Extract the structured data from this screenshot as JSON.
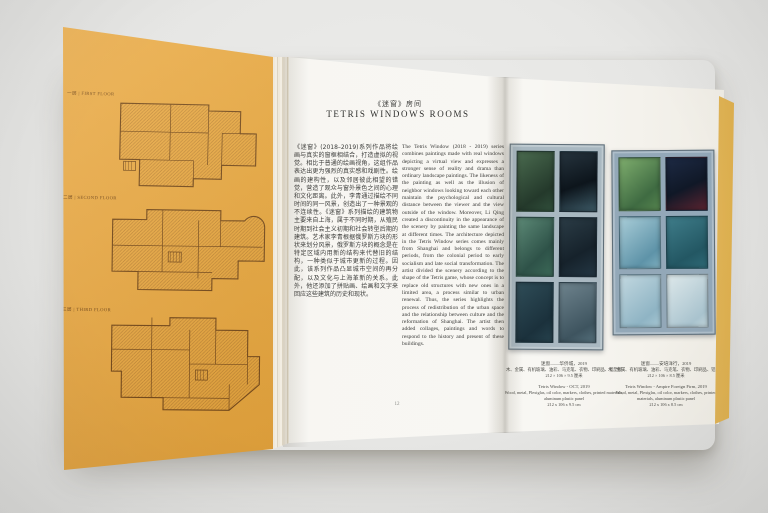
{
  "left_page": {
    "plans": [
      {
        "label": "一层 | FIRST FLOOR"
      },
      {
        "label": "二层 | SECOND FLOOR"
      },
      {
        "label": "三层 | THIRD FLOOR"
      }
    ]
  },
  "center_page": {
    "title_zh": "《迷窗》房间",
    "title_en": "TETRIS WINDOWS ROOMS",
    "body_zh": "《迷窗》(2018–2019)系列作品将绘画与真实的窗框相结合，打造虚拟的视觉。相比于普通的绘画视角，这组作品表达出更为强烈的真实感和戏剧性。绘画的建构性，以及邻居彼此相望的错觉，营造了观众与窗外景色之间的心理和文化距离。此外，李青通过描绘不同时间的同一风景，创造出了一种景观的不连续性。《迷窗》系列描绘的建筑物主要来自上海，属于不同时期，从殖民时期到社会主义初期和社会转型后期的建筑。艺术家李青根据俄罗斯方块的形状来划分风景，俄罗斯方块的概念是在特定区域内用新的结构来代替旧的结构，一种类似于城市更新的过程。因此，该系列作品凸显城市空间的再分配，以及文化与上海革新的关系。此外，他还添加了拼贴画、绘画和文字来回应这些建筑的历史和现状。",
    "body_en": "The Tetris Window (2018 - 2019) series combines paintings made with real windows depicting a virtual view and expresses a stronger sense of reality and drama than ordinary landscape paintings. The likeness of the painting as well as the illusion of neighbor windows looking toward each other maintain the psychological and cultural distance between the viewer and the view outside of the window. Moreover, Li Qing created a discontinuity in the appearance of the scenery by painting the same landscape at different times. The architecture depicted in the Tetris Window series comes mainly from Shanghai and belongs to different periods, from the colonial period to early socialism and late social transformation. The artist divided the scenery according to the shape of the Tetris game, whose concept is to replace old structures with new ones in a limited area, a process similar to urban renewal. Thus, the series highlights the process of redistribution of the urban space and the relationship between culture and the reformation of Shanghai. The artist then added collages, paintings and words to respond to the history and present of these buildings.",
    "page_number": "12"
  },
  "right_page": {
    "artworks": [
      {
        "caption_zh_title": "迷窗——华侨城，2019",
        "caption_zh_materials": "木、金属、有机玻璃、油彩、马克笔、衣物、印刷品、铝塑板",
        "caption_zh_dims": "212 × 106 × 9.5 厘米",
        "caption_en_title": "Tetris Window - OCT, 2019",
        "caption_en_materials": "Wood, metal, Plexiglas, oil color, markers, clothes, printed materials, aluminum plastic panel",
        "caption_en_dims": "212 x 106 x 9.5 cm",
        "frame_color": "#a9b8c1",
        "panes": [
          "linear-gradient(145deg,#4a6b4f,#24392b 70%,#31503c)",
          "linear-gradient(160deg,#26343e,#0d151c 55%,#3d5a66)",
          "linear-gradient(135deg,#5d8a77,#2e5248 65%,#3c6a58)",
          "linear-gradient(150deg,#2b3c46,#16222b 60%,#243744)",
          "linear-gradient(140deg,#2f4d58,#1b313c 70%,#27434e)",
          "linear-gradient(150deg,#6e838d,#3e545f 75%,#55707c)"
        ]
      },
      {
        "caption_zh_title": "迷窗——安培洋行，2019",
        "caption_zh_materials": "木、金属、有机玻璃、油彩、马克笔、衣物、印刷品、铝塑板",
        "caption_zh_dims": "212 × 106 × 8.5 厘米",
        "caption_en_title": "Tetris Window - Ampire Foreign Firm, 2019",
        "caption_en_materials": "Wood, metal, Plexiglas, oil color, markers, clothes, printed materials, aluminum plastic panel",
        "caption_en_dims": "212 x 106 x 8.5 cm",
        "frame_color": "#93a8b8",
        "panes": [
          "linear-gradient(140deg,#7fae6e,#3f6b42 70%,#56854f)",
          "linear-gradient(155deg,#1d2a44,#101827 55%,#5a2430)",
          "linear-gradient(140deg,#a9cdd8,#5e93a8 75%,#7fb0c0)",
          "linear-gradient(150deg,#3f7d8a,#235763 70%,#2f6a77)",
          "linear-gradient(140deg,#c2d8e0,#8fb4c4 75%,#a8c8d4)",
          "linear-gradient(140deg,#dde8ea,#aac4cf 80%,#c4d8de)"
        ]
      }
    ]
  },
  "colors": {
    "cover_orange": "#e2a138",
    "plan_line": "#6e4418",
    "page_white": "#f6f5f1",
    "backdrop_gray": "#e6e6e4"
  }
}
